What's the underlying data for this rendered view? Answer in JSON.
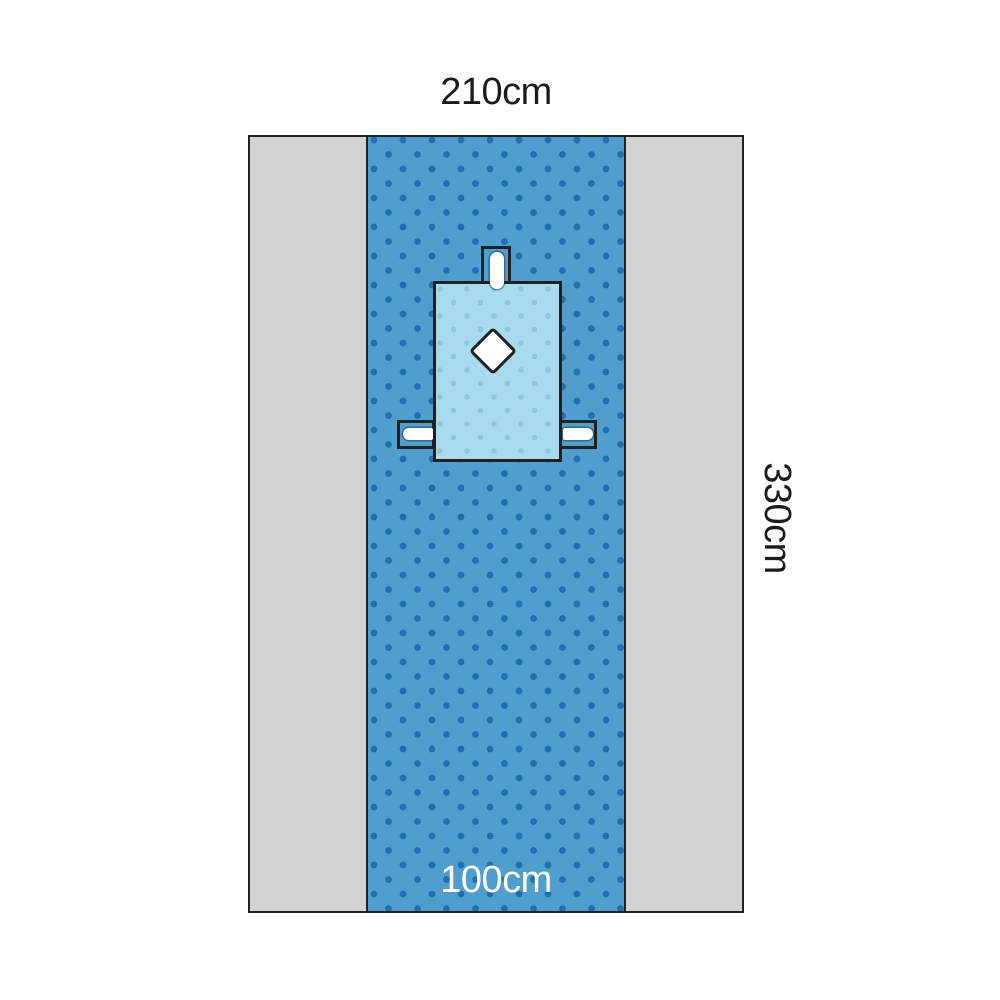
{
  "labels": {
    "top_width": "210cm",
    "right_height": "330cm",
    "band_width": "100cm"
  },
  "colors": {
    "page_bg": "#ffffff",
    "panel_gray": "#d2d3d5",
    "band_blue": "#4f9ecd",
    "band_dot": "#1e6fb4",
    "patch_blue": "#a8dbf0",
    "patch_dot": "#8cc6de",
    "outline": "#202124",
    "slot_white": "#ffffff",
    "label_dark": "#1b1b1b",
    "label_light": "#ffffff"
  },
  "icons": {
    "fenestration": "diamond-cutout",
    "tube_holder_slot": "rounded-slot"
  }
}
